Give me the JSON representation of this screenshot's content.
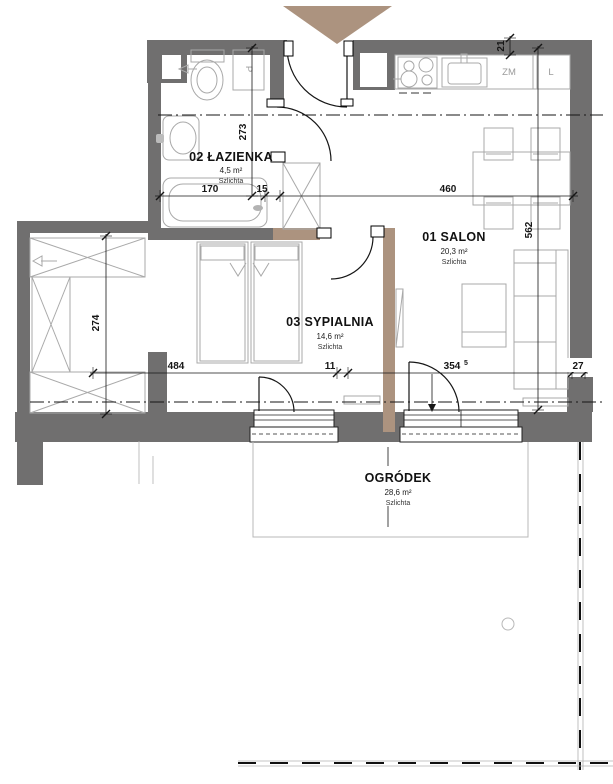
{
  "plan_labels": {
    "rooms": [
      {
        "title": "01 SALON",
        "area": "20,3 m²",
        "finish": "Szlichta"
      },
      {
        "title": "02 ŁAZIENKA",
        "area": "4,5 m²",
        "finish": "Szlichta"
      },
      {
        "title": "03 SYPIALNIA",
        "area": "14,6 m²",
        "finish": "Szlichta"
      },
      {
        "title": "OGRÓDEK",
        "area": "28,6 m²",
        "finish": "Szlichta"
      }
    ],
    "appliances": {
      "dishwasher": "ZM",
      "fridge": "L",
      "washing_machine": "P"
    },
    "dimensions": {
      "d170": "170",
      "d15": "15",
      "d460": "460",
      "d273": "273",
      "d562": "562",
      "d21": "21",
      "d274": "274",
      "d484": "484",
      "d11": "11",
      "d354": "354",
      "d354_sup": "5",
      "d27": "27"
    },
    "colors": {
      "wall_gray": "#706f6f",
      "accent_brown": "#ac937f",
      "furniture_gray": "#a9a9a9",
      "line_black": "#161616"
    }
  }
}
